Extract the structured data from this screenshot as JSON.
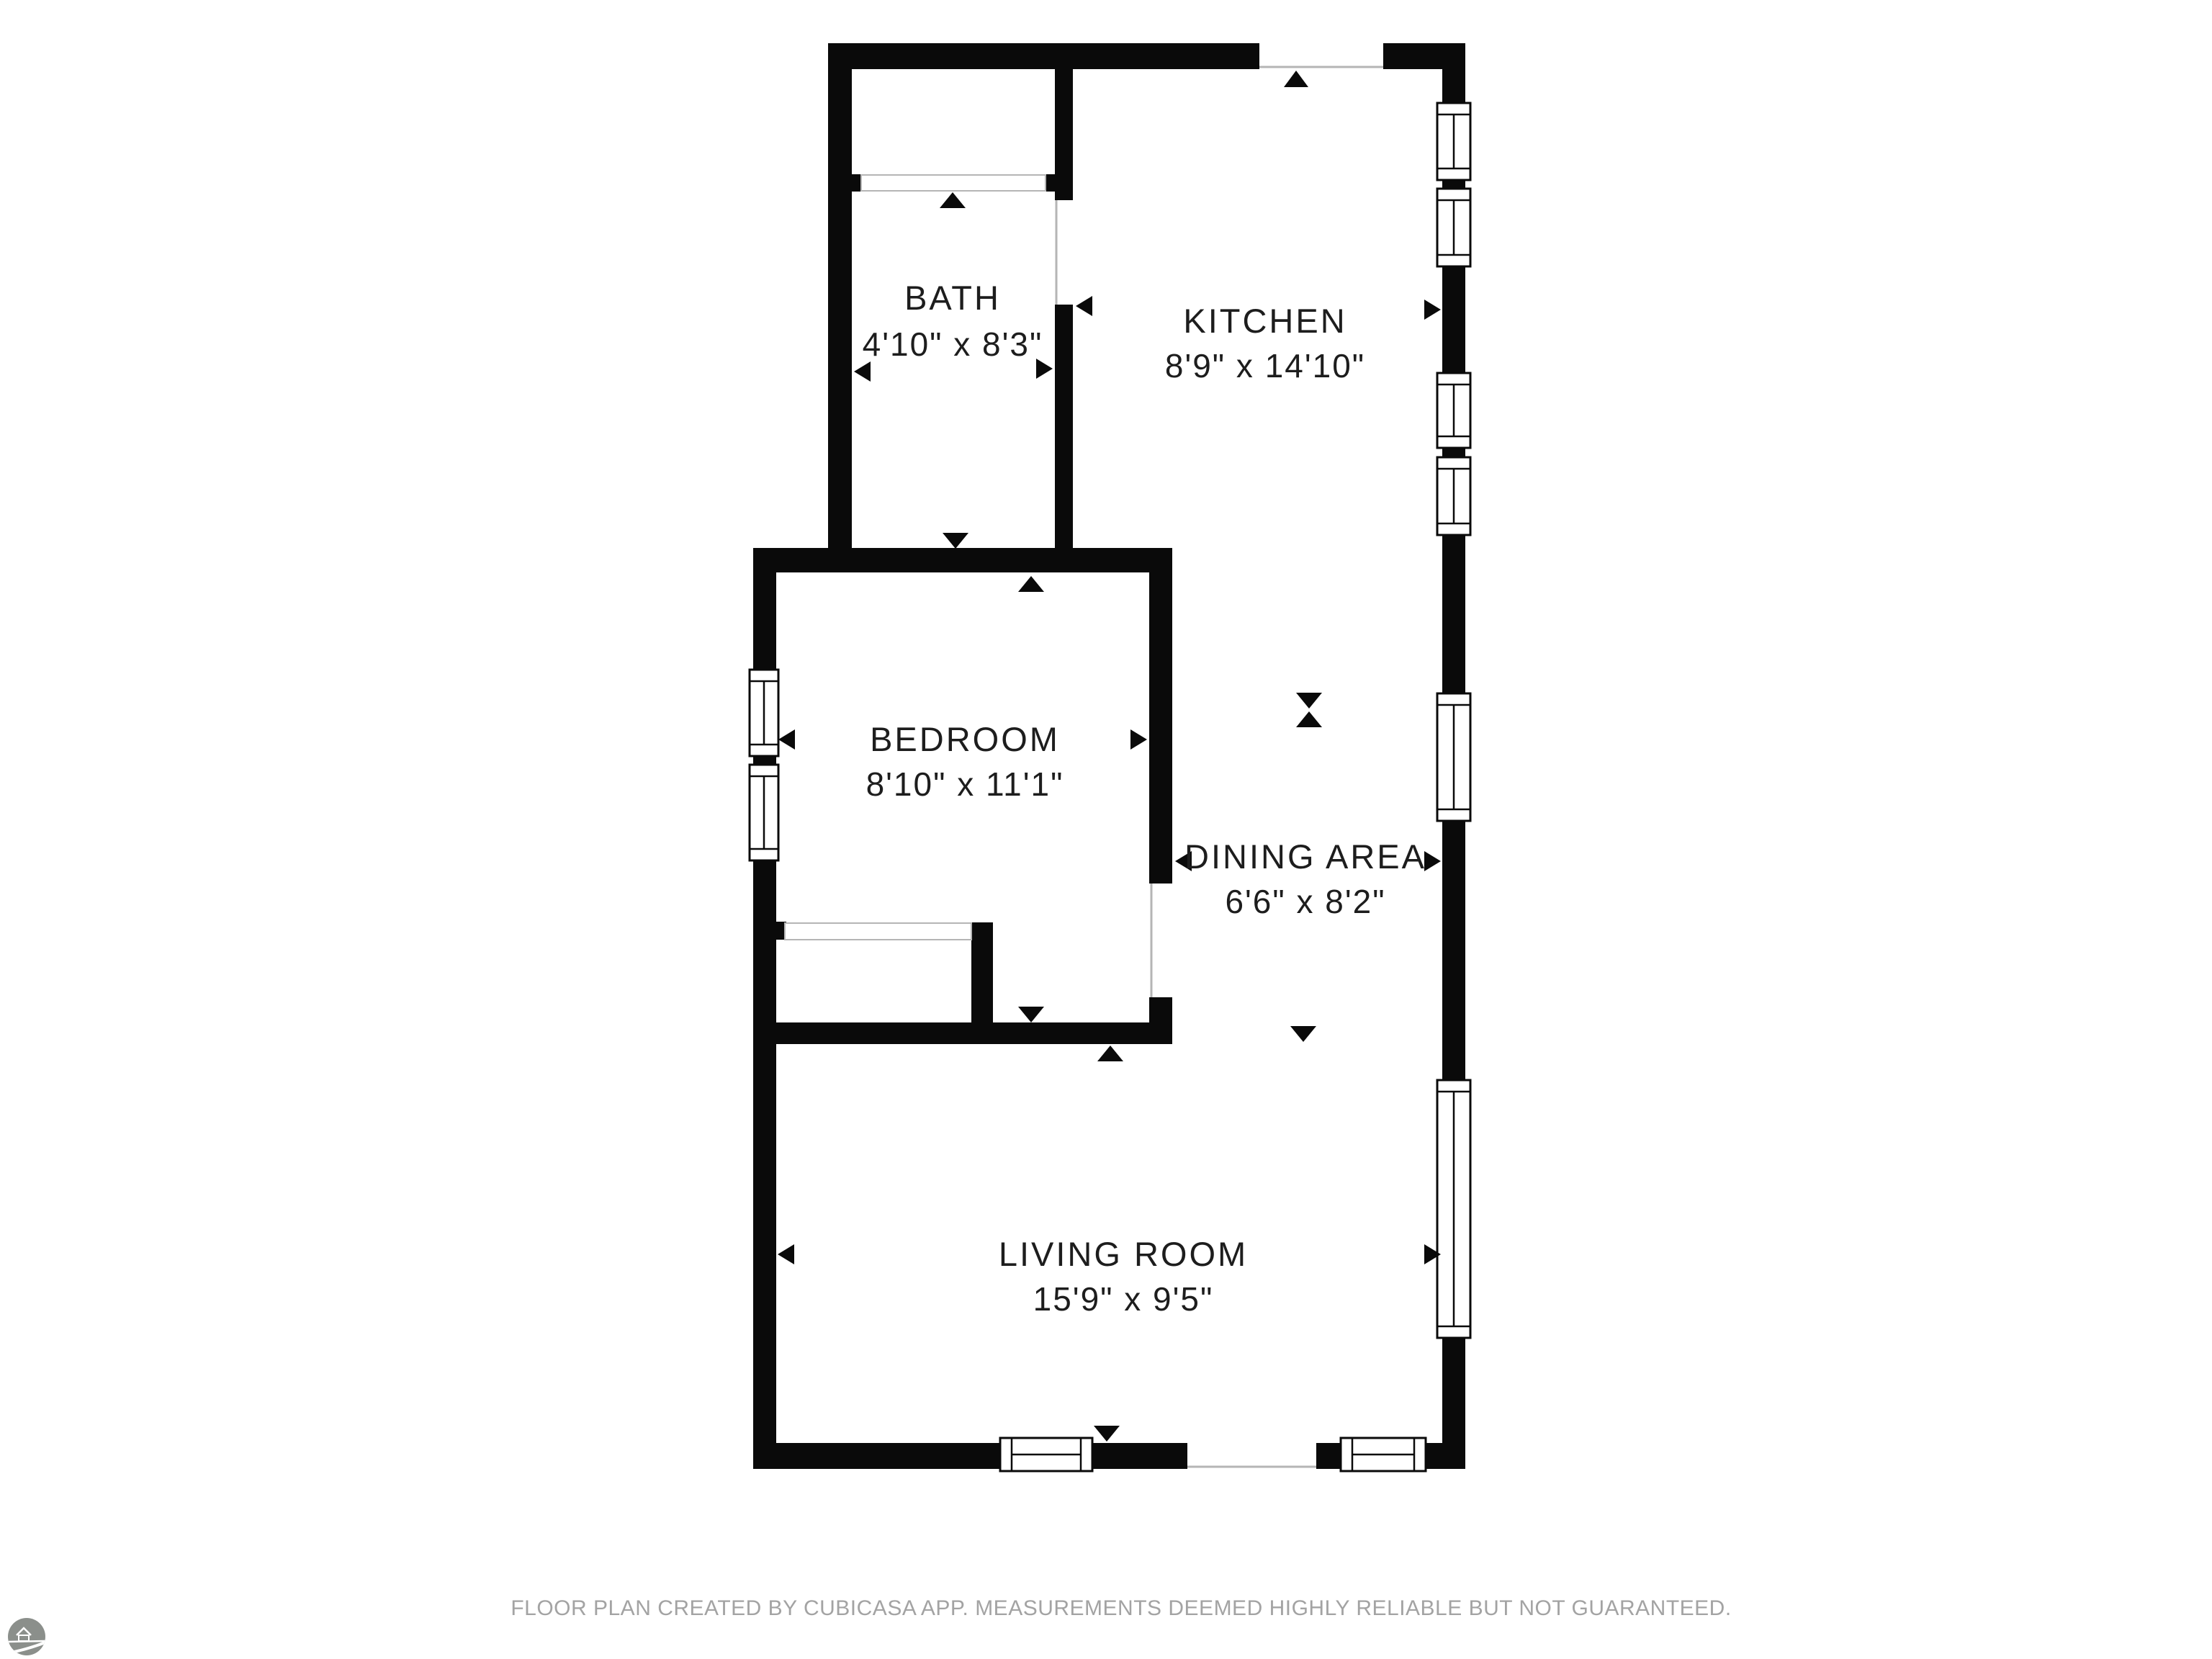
{
  "plan": {
    "rooms": [
      {
        "name": "BATH",
        "dimensions": "4'10\" x 8'3\""
      },
      {
        "name": "KITCHEN",
        "dimensions": "8'9\" x 14'10\""
      },
      {
        "name": "BEDROOM",
        "dimensions": "8'10\" x 11'1\""
      },
      {
        "name": "DINING AREA",
        "dimensions": "6'6\" x 8'2\""
      },
      {
        "name": "LIVING ROOM",
        "dimensions": "15'9\" x 9'5\""
      }
    ],
    "colors": {
      "wall": "#0a0a0a",
      "door_line": "#b5b5b5",
      "label_text": "#1d1d1d",
      "footer_text": "#a3a3a3",
      "logo": "#8b8f8b"
    }
  },
  "branding": {
    "logo_icon": "cubicasa-logo"
  },
  "footer": {
    "text": "FLOOR PLAN CREATED BY CUBICASA APP. MEASUREMENTS DEEMED HIGHLY RELIABLE BUT NOT GUARANTEED."
  }
}
